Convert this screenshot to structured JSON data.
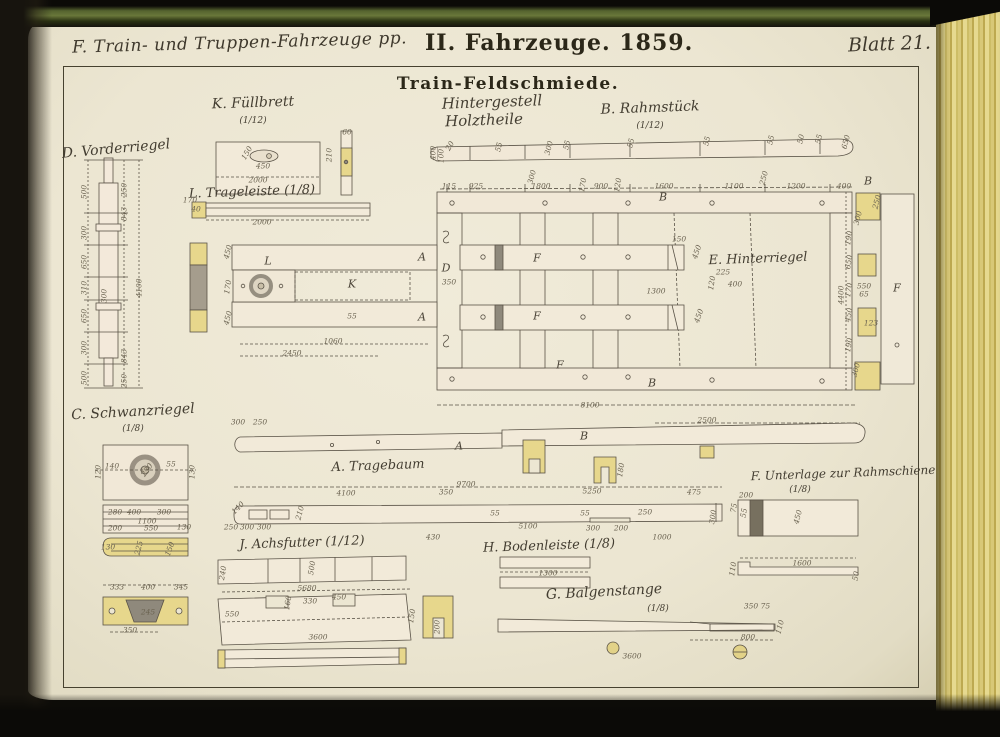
{
  "header": {
    "left": "F. Train- und Truppen-Fahrzeuge pp.",
    "center": "II. Fahrzeuge. 1859.",
    "right": "Blatt 21."
  },
  "title": {
    "main": "Train-Feldschmiede.",
    "sub1": "Hintergestell",
    "sub2": "Holztheile"
  },
  "colors": {
    "paper": "#ece6d2",
    "ink": "#46412f",
    "wood_fill": "#f2ead9",
    "highlight_yellow": "#e7d78c",
    "shadow_gray": "#8f897c",
    "cover_olive": "#69773a",
    "fore_edge_yellow": "#d8c877"
  },
  "drawing": {
    "part_labels": [
      {
        "name": "k-fuellbrett",
        "text": "K. Füllbrett",
        "sub": "(1/12)",
        "x": 253,
        "y": 103,
        "suby": 121,
        "rot": -2,
        "size": 14
      },
      {
        "name": "b-rahmstueck",
        "text": "B. Rahmstück",
        "sub": "(1/12)",
        "x": 650,
        "y": 108,
        "suby": 126,
        "rot": -2,
        "size": 14
      },
      {
        "name": "d-vorderriegel",
        "text": "D. Vorderriegel",
        "x": 116,
        "y": 149,
        "rot": -5,
        "size": 14
      },
      {
        "name": "l-trageleiste",
        "text": "L. Trageleiste (1/8)",
        "x": 252,
        "y": 192,
        "rot": -2,
        "size": 13
      },
      {
        "name": "e-hinterriegel",
        "text": "E. Hinterriegel",
        "x": 758,
        "y": 259,
        "rot": -2,
        "size": 13
      },
      {
        "name": "c-schwanzriegel",
        "text": "C. Schwanzriegel",
        "sub": "(1/8)",
        "x": 133,
        "y": 412,
        "suby": 429,
        "rot": -3,
        "size": 14
      },
      {
        "name": "a-tragebaum",
        "text": "A. Tragebaum",
        "x": 378,
        "y": 466,
        "rot": -2,
        "size": 13
      },
      {
        "name": "f-unterlage",
        "text": "F. Unterlage zur Rahmschiene",
        "sub": "(1/8)",
        "x": 843,
        "y": 473,
        "subx": 800,
        "suby": 490,
        "rot": -2,
        "size": 12
      },
      {
        "name": "j-achsfutter",
        "text": "J. Achsfutter (1/12)",
        "x": 302,
        "y": 543,
        "rot": -2,
        "size": 13
      },
      {
        "name": "h-bodenleiste",
        "text": "H. Bodenleiste (1/8)",
        "x": 549,
        "y": 546,
        "rot": -2,
        "size": 13
      },
      {
        "name": "g-balgenstange",
        "text": "G. Balgenstange",
        "sub": "(1/8)",
        "x": 604,
        "y": 592,
        "subx": 658,
        "suby": 609,
        "rot": -3,
        "size": 14
      }
    ],
    "dimensions": [
      {
        "t": "400",
        "x": 433,
        "y": 153,
        "r": -90
      },
      {
        "t": "100",
        "x": 441,
        "y": 156,
        "r": -90
      },
      {
        "t": "20",
        "x": 450,
        "y": 146,
        "r": -60
      },
      {
        "t": "55",
        "x": 499,
        "y": 147,
        "r": -75
      },
      {
        "t": "300",
        "x": 549,
        "y": 148,
        "r": -75
      },
      {
        "t": "55",
        "x": 567,
        "y": 145,
        "r": -75
      },
      {
        "t": "55",
        "x": 631,
        "y": 143,
        "r": -75
      },
      {
        "t": "55",
        "x": 707,
        "y": 141,
        "r": -75
      },
      {
        "t": "55",
        "x": 771,
        "y": 140,
        "r": -75
      },
      {
        "t": "50",
        "x": 801,
        "y": 139,
        "r": -75
      },
      {
        "t": "55",
        "x": 819,
        "y": 139,
        "r": -75
      },
      {
        "t": "650",
        "x": 846,
        "y": 142,
        "r": -75
      },
      {
        "t": "115",
        "x": 449,
        "y": 186
      },
      {
        "t": "925",
        "x": 476,
        "y": 186
      },
      {
        "t": "1800",
        "x": 541,
        "y": 186
      },
      {
        "t": "900",
        "x": 601,
        "y": 186
      },
      {
        "t": "1600",
        "x": 664,
        "y": 186
      },
      {
        "t": "1100",
        "x": 734,
        "y": 186
      },
      {
        "t": "1200",
        "x": 796,
        "y": 186
      },
      {
        "t": "400",
        "x": 844,
        "y": 186
      },
      {
        "t": "300",
        "x": 532,
        "y": 177,
        "r": -75
      },
      {
        "t": "170",
        "x": 583,
        "y": 185,
        "r": -80
      },
      {
        "t": "120",
        "x": 618,
        "y": 185,
        "r": -80
      },
      {
        "t": "B",
        "x": 663,
        "y": 197,
        "c": "s"
      },
      {
        "t": "250",
        "x": 764,
        "y": 178,
        "r": -75
      },
      {
        "t": "150",
        "x": 679,
        "y": 239
      },
      {
        "t": "450",
        "x": 697,
        "y": 252,
        "r": -70
      },
      {
        "t": "225",
        "x": 723,
        "y": 272
      },
      {
        "t": "1300",
        "x": 656,
        "y": 291
      },
      {
        "t": "120",
        "x": 712,
        "y": 283,
        "r": -80
      },
      {
        "t": "400",
        "x": 735,
        "y": 284
      },
      {
        "t": "450",
        "x": 699,
        "y": 316,
        "r": -70
      },
      {
        "t": "D",
        "x": 446,
        "y": 268,
        "c": "s"
      },
      {
        "t": "350",
        "x": 449,
        "y": 282
      },
      {
        "t": "450",
        "x": 228,
        "y": 252,
        "r": -75
      },
      {
        "t": "170",
        "x": 228,
        "y": 287,
        "r": -80
      },
      {
        "t": "450",
        "x": 228,
        "y": 318,
        "r": -75
      },
      {
        "t": "L",
        "x": 268,
        "y": 261,
        "c": "s"
      },
      {
        "t": "K",
        "x": 352,
        "y": 284,
        "c": "s"
      },
      {
        "t": "55",
        "x": 352,
        "y": 316
      },
      {
        "t": "1060",
        "x": 333,
        "y": 341
      },
      {
        "t": "2450",
        "x": 292,
        "y": 353
      },
      {
        "t": "A",
        "x": 422,
        "y": 257,
        "c": "s"
      },
      {
        "t": "A",
        "x": 422,
        "y": 317,
        "c": "s"
      },
      {
        "t": "F",
        "x": 537,
        "y": 258,
        "c": "s"
      },
      {
        "t": "F",
        "x": 537,
        "y": 316,
        "c": "s"
      },
      {
        "t": "F",
        "x": 560,
        "y": 365,
        "c": "s"
      },
      {
        "t": "B",
        "x": 652,
        "y": 383,
        "c": "s"
      },
      {
        "t": "8100",
        "x": 590,
        "y": 405
      },
      {
        "t": "2500",
        "x": 707,
        "y": 420
      },
      {
        "t": "300",
        "x": 238,
        "y": 422
      },
      {
        "t": "250",
        "x": 260,
        "y": 422
      },
      {
        "t": "A",
        "x": 459,
        "y": 446,
        "c": "s"
      },
      {
        "t": "B",
        "x": 584,
        "y": 436,
        "c": "s"
      },
      {
        "t": "250",
        "x": 877,
        "y": 202,
        "r": -75
      },
      {
        "t": "300",
        "x": 858,
        "y": 218,
        "r": -75
      },
      {
        "t": "190",
        "x": 849,
        "y": 238,
        "r": -80
      },
      {
        "t": "650",
        "x": 849,
        "y": 262,
        "r": -80
      },
      {
        "t": "170",
        "x": 849,
        "y": 290,
        "r": -80
      },
      {
        "t": "550",
        "x": 864,
        "y": 286
      },
      {
        "t": "65",
        "x": 864,
        "y": 294
      },
      {
        "t": "450",
        "x": 849,
        "y": 315,
        "r": -80
      },
      {
        "t": "123",
        "x": 871,
        "y": 323
      },
      {
        "t": "190",
        "x": 849,
        "y": 345,
        "r": -80
      },
      {
        "t": "300",
        "x": 856,
        "y": 370,
        "r": -75
      },
      {
        "t": "4400",
        "x": 841,
        "y": 295,
        "r": -90
      },
      {
        "t": "F",
        "x": 897,
        "y": 288,
        "c": "s"
      },
      {
        "t": "B",
        "x": 868,
        "y": 181,
        "c": "s"
      },
      {
        "t": "500",
        "x": 84,
        "y": 192,
        "r": -90
      },
      {
        "t": "300",
        "x": 84,
        "y": 233,
        "r": -90
      },
      {
        "t": "650",
        "x": 84,
        "y": 262,
        "r": -90
      },
      {
        "t": "310",
        "x": 84,
        "y": 288,
        "r": -90
      },
      {
        "t": "650",
        "x": 84,
        "y": 316,
        "r": -90
      },
      {
        "t": "300",
        "x": 84,
        "y": 348,
        "r": -90
      },
      {
        "t": "500",
        "x": 84,
        "y": 378,
        "r": -90
      },
      {
        "t": "250",
        "x": 124,
        "y": 190,
        "r": -90
      },
      {
        "t": "843",
        "x": 124,
        "y": 214,
        "r": -90
      },
      {
        "t": "4100",
        "x": 139,
        "y": 288,
        "r": -90
      },
      {
        "t": "300",
        "x": 104,
        "y": 296,
        "r": -90
      },
      {
        "t": "843",
        "x": 124,
        "y": 356,
        "r": -90
      },
      {
        "t": "250",
        "x": 124,
        "y": 381,
        "r": -90
      },
      {
        "t": "150",
        "x": 247,
        "y": 153,
        "r": -60
      },
      {
        "t": "450",
        "x": 263,
        "y": 166
      },
      {
        "t": "2000",
        "x": 258,
        "y": 180
      },
      {
        "t": "210",
        "x": 329,
        "y": 155,
        "r": -90
      },
      {
        "t": "60",
        "x": 347,
        "y": 132
      },
      {
        "t": "170",
        "x": 190,
        "y": 200
      },
      {
        "t": "40",
        "x": 196,
        "y": 209
      },
      {
        "t": "2000",
        "x": 262,
        "y": 222
      },
      {
        "t": "140",
        "x": 112,
        "y": 466
      },
      {
        "t": "55",
        "x": 171,
        "y": 464
      },
      {
        "t": "120",
        "x": 98,
        "y": 472,
        "r": -90
      },
      {
        "t": "130",
        "x": 192,
        "y": 472,
        "r": -90
      },
      {
        "t": "230",
        "x": 147,
        "y": 470,
        "r": -55
      },
      {
        "t": "280",
        "x": 115,
        "y": 512
      },
      {
        "t": "400",
        "x": 134,
        "y": 512
      },
      {
        "t": "300",
        "x": 164,
        "y": 512
      },
      {
        "t": "1100",
        "x": 147,
        "y": 521
      },
      {
        "t": "200",
        "x": 115,
        "y": 528
      },
      {
        "t": "550",
        "x": 151,
        "y": 528
      },
      {
        "t": "130",
        "x": 184,
        "y": 527
      },
      {
        "t": "130",
        "x": 108,
        "y": 547
      },
      {
        "t": "225",
        "x": 139,
        "y": 548,
        "r": -75
      },
      {
        "t": "150",
        "x": 170,
        "y": 549,
        "r": -70
      },
      {
        "t": "333",
        "x": 117,
        "y": 587
      },
      {
        "t": "400",
        "x": 148,
        "y": 587
      },
      {
        "t": "345",
        "x": 181,
        "y": 587
      },
      {
        "t": "245",
        "x": 148,
        "y": 612
      },
      {
        "t": "350",
        "x": 130,
        "y": 630
      },
      {
        "t": "9700",
        "x": 466,
        "y": 484
      },
      {
        "t": "4100",
        "x": 346,
        "y": 493
      },
      {
        "t": "350",
        "x": 446,
        "y": 492
      },
      {
        "t": "5250",
        "x": 592,
        "y": 491
      },
      {
        "t": "475",
        "x": 694,
        "y": 492
      },
      {
        "t": "140",
        "x": 238,
        "y": 508,
        "r": -45
      },
      {
        "t": "250",
        "x": 231,
        "y": 527
      },
      {
        "t": "300",
        "x": 247,
        "y": 527
      },
      {
        "t": "300",
        "x": 264,
        "y": 527
      },
      {
        "t": "210",
        "x": 300,
        "y": 513,
        "r": -75
      },
      {
        "t": "430",
        "x": 433,
        "y": 537
      },
      {
        "t": "5100",
        "x": 528,
        "y": 526
      },
      {
        "t": "55",
        "x": 495,
        "y": 513
      },
      {
        "t": "55",
        "x": 585,
        "y": 513
      },
      {
        "t": "300",
        "x": 593,
        "y": 528
      },
      {
        "t": "200",
        "x": 621,
        "y": 528
      },
      {
        "t": "250",
        "x": 645,
        "y": 512
      },
      {
        "t": "1000",
        "x": 662,
        "y": 537
      },
      {
        "t": "300",
        "x": 713,
        "y": 517,
        "r": -80
      },
      {
        "t": "180",
        "x": 621,
        "y": 470,
        "r": -80
      },
      {
        "t": "200",
        "x": 746,
        "y": 495
      },
      {
        "t": "75",
        "x": 734,
        "y": 508,
        "r": -80
      },
      {
        "t": "55",
        "x": 744,
        "y": 513,
        "r": -80
      },
      {
        "t": "450",
        "x": 798,
        "y": 517,
        "r": -75
      },
      {
        "t": "1600",
        "x": 802,
        "y": 563
      },
      {
        "t": "110",
        "x": 733,
        "y": 569,
        "r": -80
      },
      {
        "t": "50",
        "x": 856,
        "y": 576,
        "r": -80
      },
      {
        "t": "240",
        "x": 223,
        "y": 573,
        "r": -80
      },
      {
        "t": "500",
        "x": 312,
        "y": 568,
        "r": -80
      },
      {
        "t": "5680",
        "x": 307,
        "y": 588
      },
      {
        "t": "330",
        "x": 310,
        "y": 601
      },
      {
        "t": "450",
        "x": 339,
        "y": 597
      },
      {
        "t": "160",
        "x": 288,
        "y": 603,
        "r": -80
      },
      {
        "t": "550",
        "x": 232,
        "y": 614
      },
      {
        "t": "3600",
        "x": 318,
        "y": 637
      },
      {
        "t": "150",
        "x": 412,
        "y": 616,
        "r": -80
      },
      {
        "t": "200",
        "x": 437,
        "y": 627,
        "r": -90
      },
      {
        "t": "1300",
        "x": 548,
        "y": 573
      },
      {
        "t": "350 75",
        "x": 757,
        "y": 606
      },
      {
        "t": "800",
        "x": 748,
        "y": 637
      },
      {
        "t": "110",
        "x": 780,
        "y": 627,
        "r": -75
      },
      {
        "t": "3600",
        "x": 632,
        "y": 656
      }
    ]
  }
}
